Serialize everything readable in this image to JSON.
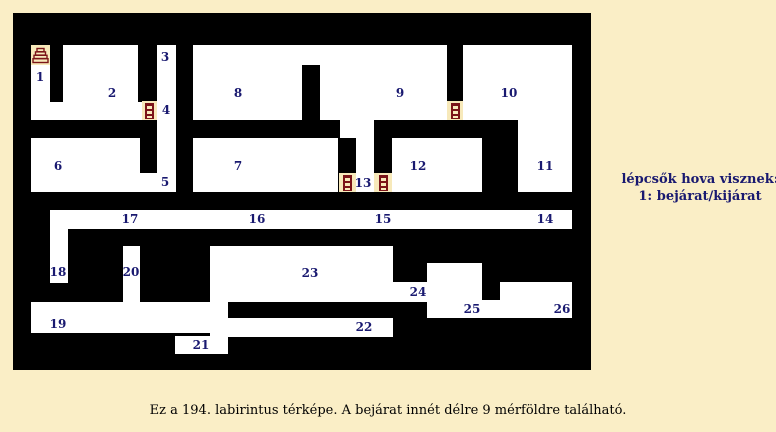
{
  "page": {
    "background": "#faeec6",
    "caption": "Ez a 194. labirintus térképe. A bejárat innét délre 9 mérföldre található."
  },
  "legend": {
    "line1": "lépcsők hova visznek:",
    "line2": "1: bejárat/kijárat"
  },
  "colors": {
    "wall": "#000000",
    "room": "#ffffff",
    "label": "#191970",
    "icon_bg": "#f7e9ba",
    "icon_fg": "#7b1418"
  },
  "maze": {
    "x": 13,
    "y": 13,
    "width": 578,
    "height": 357,
    "rooms": [
      {
        "x": 31,
        "y": 45,
        "w": 19,
        "h": 75
      },
      {
        "x": 63,
        "y": 45,
        "w": 75,
        "h": 57
      },
      {
        "x": 31,
        "y": 102,
        "w": 111,
        "h": 18
      },
      {
        "x": 157,
        "y": 45,
        "w": 19,
        "h": 147
      },
      {
        "x": 193,
        "y": 45,
        "w": 109,
        "h": 75
      },
      {
        "x": 302,
        "y": 45,
        "w": 18,
        "h": 20
      },
      {
        "x": 320,
        "y": 45,
        "w": 127,
        "h": 75
      },
      {
        "x": 463,
        "y": 45,
        "w": 109,
        "h": 75
      },
      {
        "x": 31,
        "y": 138,
        "w": 109,
        "h": 54
      },
      {
        "x": 140,
        "y": 173,
        "w": 17,
        "h": 19
      },
      {
        "x": 193,
        "y": 138,
        "w": 145,
        "h": 54
      },
      {
        "x": 340,
        "y": 120,
        "w": 34,
        "h": 18
      },
      {
        "x": 356,
        "y": 138,
        "w": 18,
        "h": 54
      },
      {
        "x": 392,
        "y": 138,
        "w": 90,
        "h": 54
      },
      {
        "x": 518,
        "y": 120,
        "w": 54,
        "h": 72
      },
      {
        "x": 50,
        "y": 210,
        "w": 522,
        "h": 19
      },
      {
        "x": 50,
        "y": 229,
        "w": 18,
        "h": 54
      },
      {
        "x": 123,
        "y": 246,
        "w": 17,
        "h": 56
      },
      {
        "x": 31,
        "y": 302,
        "w": 179,
        "h": 31
      },
      {
        "x": 210,
        "y": 246,
        "w": 18,
        "h": 108
      },
      {
        "x": 210,
        "y": 246,
        "w": 183,
        "h": 56
      },
      {
        "x": 393,
        "y": 282,
        "w": 37,
        "h": 20
      },
      {
        "x": 427,
        "y": 263,
        "w": 55,
        "h": 55
      },
      {
        "x": 427,
        "y": 300,
        "w": 145,
        "h": 18
      },
      {
        "x": 500,
        "y": 282,
        "w": 72,
        "h": 36
      },
      {
        "x": 228,
        "y": 318,
        "w": 165,
        "h": 19
      },
      {
        "x": 175,
        "y": 336,
        "w": 53,
        "h": 18
      }
    ],
    "icon_cells": [
      {
        "type": "stairs",
        "x": 31,
        "y": 45,
        "w": 19,
        "h": 20
      },
      {
        "type": "ladder",
        "x": 142,
        "y": 101,
        "w": 15,
        "h": 19
      },
      {
        "type": "ladder",
        "x": 447,
        "y": 101,
        "w": 16,
        "h": 19
      },
      {
        "type": "ladder",
        "x": 339,
        "y": 173,
        "w": 17,
        "h": 19
      },
      {
        "type": "ladder",
        "x": 374,
        "y": 173,
        "w": 18,
        "h": 19
      }
    ],
    "labels": [
      {
        "text": "1",
        "x": 40,
        "y": 77
      },
      {
        "text": "2",
        "x": 112,
        "y": 93
      },
      {
        "text": "3",
        "x": 165,
        "y": 57
      },
      {
        "text": "4",
        "x": 166,
        "y": 110
      },
      {
        "text": "5",
        "x": 165,
        "y": 182
      },
      {
        "text": "6",
        "x": 58,
        "y": 166
      },
      {
        "text": "7",
        "x": 238,
        "y": 166
      },
      {
        "text": "8",
        "x": 238,
        "y": 93
      },
      {
        "text": "9",
        "x": 400,
        "y": 93
      },
      {
        "text": "10",
        "x": 509,
        "y": 93
      },
      {
        "text": "11",
        "x": 545,
        "y": 166
      },
      {
        "text": "12",
        "x": 418,
        "y": 166
      },
      {
        "text": "13",
        "x": 363,
        "y": 183
      },
      {
        "text": "14",
        "x": 545,
        "y": 219
      },
      {
        "text": "15",
        "x": 383,
        "y": 219
      },
      {
        "text": "16",
        "x": 257,
        "y": 219
      },
      {
        "text": "17",
        "x": 130,
        "y": 219
      },
      {
        "text": "18",
        "x": 58,
        "y": 272
      },
      {
        "text": "19",
        "x": 58,
        "y": 324
      },
      {
        "text": "20",
        "x": 131,
        "y": 272
      },
      {
        "text": "21",
        "x": 201,
        "y": 345
      },
      {
        "text": "22",
        "x": 364,
        "y": 327
      },
      {
        "text": "23",
        "x": 310,
        "y": 273
      },
      {
        "text": "24",
        "x": 418,
        "y": 292
      },
      {
        "text": "25",
        "x": 472,
        "y": 309
      },
      {
        "text": "26",
        "x": 562,
        "y": 309
      }
    ]
  }
}
